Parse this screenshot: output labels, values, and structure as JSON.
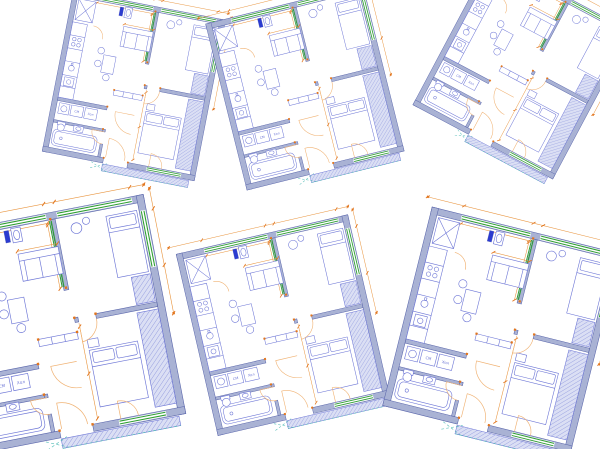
{
  "document": {
    "description": "Six similar CAD floor plans of a one-bedroom apartment scattered at different angles on a white background",
    "background": "#ffffff"
  },
  "palette": {
    "wall_fill": "#a9b2d4",
    "wall_stroke": "#5a66ab",
    "furniture": "#6d76d6",
    "window_green": "#2f9e33",
    "dim_orange": "#e8933c",
    "tick_orange": "#e2751d",
    "door_tan": "#f0b273",
    "hatch_fill": "#dbdff4",
    "hatch_line": "#8d96dd",
    "teal": "#52bcb6",
    "accent_blue": "#2b3bd0"
  },
  "labels": {
    "washing_machine": "СМ",
    "fridge": "Хол"
  },
  "plans": [
    {
      "id": "floor-plan-top-left",
      "cx": 133,
      "cy": 90,
      "rotation": 11,
      "scale": 0.44
    },
    {
      "id": "floor-plan-top-middle",
      "cx": 306,
      "cy": 92,
      "rotation": -14,
      "scale": 0.46
    },
    {
      "id": "floor-plan-top-right",
      "cx": 520,
      "cy": 72,
      "rotation": 28,
      "scale": 0.45
    },
    {
      "id": "floor-plan-bottom-left",
      "cx": 62,
      "cy": 330,
      "rotation": -11,
      "scale": 0.6
    },
    {
      "id": "floor-plan-bottom-middle",
      "cx": 284,
      "cy": 330,
      "rotation": -13,
      "scale": 0.5
    },
    {
      "id": "floor-plan-bottom-right",
      "cx": 500,
      "cy": 335,
      "rotation": 14,
      "scale": 0.55
    }
  ]
}
